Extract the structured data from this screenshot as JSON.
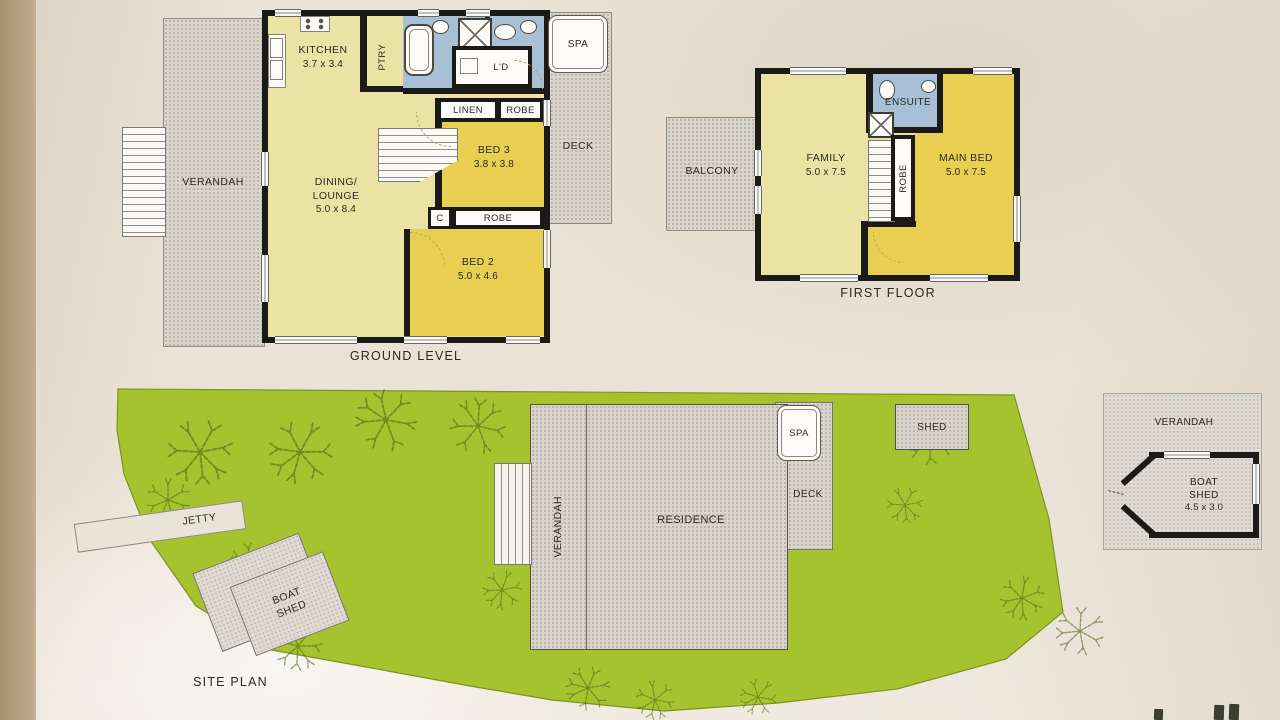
{
  "ground_level": {
    "title": "GROUND LEVEL",
    "verandah": "VERANDAH",
    "kitchen_name": "KITCHEN",
    "kitchen_dims": "3.7 x 3.4",
    "pantry": "PTRY",
    "laundry": "L'D",
    "linen": "LINEN",
    "robe_bed3": "ROBE",
    "bed3_name": "BED 3",
    "bed3_dims": "3.8 x 3.8",
    "cupboard": "C",
    "robe_bed2": "ROBE",
    "bed2_name": "BED 2",
    "bed2_dims": "5.0 x 4.6",
    "dining_line1": "DINING/",
    "dining_line2": "LOUNGE",
    "dining_dims": "5.0 x 8.4",
    "spa": "SPA",
    "deck": "DECK"
  },
  "first_floor": {
    "title": "FIRST FLOOR",
    "balcony": "BALCONY",
    "family_name": "FAMILY",
    "family_dims": "5.0 x 7.5",
    "ensuite": "ENSUITE",
    "robe": "ROBE",
    "main_bed_name": "MAIN BED",
    "main_bed_dims": "5.0 x 7.5"
  },
  "site_plan": {
    "title": "SITE PLAN",
    "jetty": "JETTY",
    "boat_shed_line1": "BOAT",
    "boat_shed_line2": "SHED",
    "verandah": "VERANDAH",
    "residence": "RESIDENCE",
    "spa": "SPA",
    "deck": "DECK",
    "shed": "SHED"
  },
  "boat_shed_detail": {
    "verandah": "VERANDAH",
    "name_line1": "BOAT",
    "name_line2": "SHED",
    "dims": "4.5 x 3.0"
  },
  "colors": {
    "room_pale_yellow": "#eae3a3",
    "room_bright_yellow": "#e8cf52",
    "wet_area_blue": "#a7c0d6",
    "grass_green": "#a6c22e",
    "hard_surface_grey": "#d9d5cc",
    "wall_black": "#1b1a17",
    "paper": "#e9e1d5"
  }
}
